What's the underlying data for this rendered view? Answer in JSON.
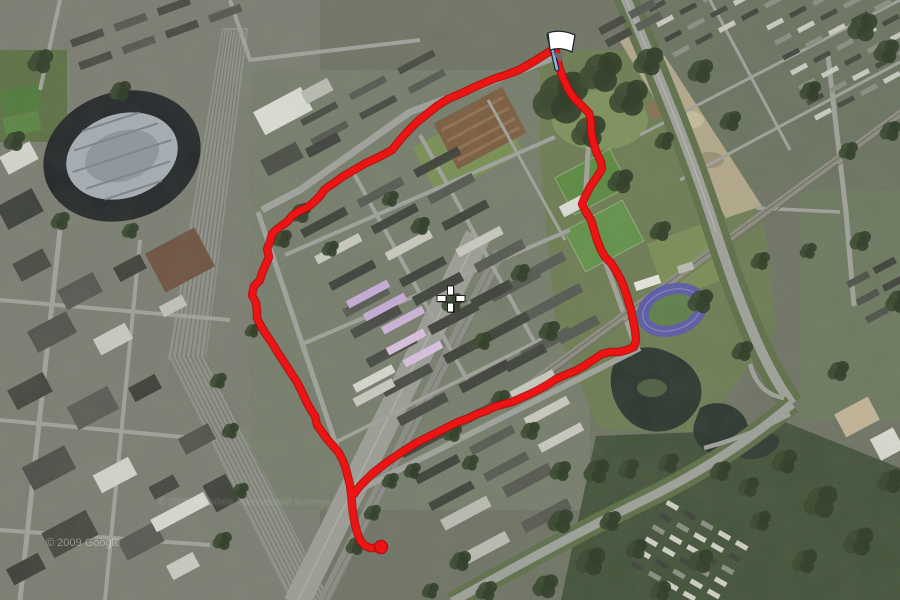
{
  "map_view": {
    "description": "Satellite aerial map with red GPS running route overlay",
    "watermark_primary": "© 2009 Google",
    "watermark_secondary": "© 2009 Aerodata International Surveys",
    "crosshair": {
      "x": 450.5,
      "y": 298.5
    },
    "flag_marker": {
      "x": 549,
      "y": 35,
      "pole_color": "#8fb6e8",
      "flag_color": "#ffffff",
      "outline_color": "#1d2733"
    },
    "route": {
      "color": "#ee1414",
      "outline_color": "#b50d0d",
      "width": 6,
      "end_dot": {
        "x": 381,
        "y": 547,
        "r": 6.5
      },
      "polylines": {
        "west_leg_and_tail": [
          [
            552,
            50
          ],
          [
            533,
            62
          ],
          [
            519,
            70
          ],
          [
            506,
            75
          ],
          [
            496,
            78
          ],
          [
            477,
            86
          ],
          [
            462,
            93
          ],
          [
            448,
            99
          ],
          [
            437,
            106
          ],
          [
            427,
            114
          ],
          [
            417,
            122
          ],
          [
            407,
            132
          ],
          [
            400,
            140
          ],
          [
            392,
            150
          ],
          [
            379,
            157
          ],
          [
            366,
            163
          ],
          [
            354,
            170
          ],
          [
            342,
            177
          ],
          [
            334,
            183
          ],
          [
            325,
            189
          ],
          [
            320,
            196
          ],
          [
            314,
            202
          ],
          [
            308,
            207
          ],
          [
            299,
            211
          ],
          [
            292,
            216
          ],
          [
            287,
            222
          ],
          [
            277,
            229
          ],
          [
            272,
            234
          ],
          [
            270,
            242
          ],
          [
            267,
            249
          ],
          [
            269,
            257
          ],
          [
            265,
            266
          ],
          [
            262,
            273
          ],
          [
            260,
            280
          ],
          [
            254,
            286
          ],
          [
            252,
            295
          ],
          [
            256,
            303
          ],
          [
            257,
            311
          ],
          [
            257,
            318
          ],
          [
            261,
            326
          ],
          [
            265,
            333
          ],
          [
            272,
            343
          ],
          [
            278,
            353
          ],
          [
            284,
            362
          ],
          [
            291,
            373
          ],
          [
            297,
            382
          ],
          [
            302,
            392
          ],
          [
            307,
            403
          ],
          [
            311,
            410
          ],
          [
            315,
            416
          ],
          [
            317,
            425
          ],
          [
            322,
            432
          ],
          [
            327,
            439
          ],
          [
            334,
            447
          ],
          [
            339,
            453
          ],
          [
            343,
            461
          ],
          [
            346,
            469
          ],
          [
            348,
            477
          ],
          [
            350,
            485
          ],
          [
            351,
            493
          ],
          [
            352,
            504
          ],
          [
            353,
            514
          ],
          [
            355,
            524
          ],
          [
            357,
            532
          ],
          [
            360,
            540
          ],
          [
            364,
            545
          ],
          [
            370,
            548
          ],
          [
            377,
            548
          ],
          [
            382,
            546
          ]
        ],
        "east_leg_and_south_return": [
          [
            556,
            52
          ],
          [
            559,
            67
          ],
          [
            563,
            78
          ],
          [
            568,
            89
          ],
          [
            574,
            98
          ],
          [
            583,
            107
          ],
          [
            589,
            113
          ],
          [
            591,
            122
          ],
          [
            591,
            131
          ],
          [
            593,
            141
          ],
          [
            596,
            151
          ],
          [
            601,
            162
          ],
          [
            602,
            169
          ],
          [
            597,
            177
          ],
          [
            590,
            187
          ],
          [
            585,
            197
          ],
          [
            582,
            204
          ],
          [
            586,
            212
          ],
          [
            591,
            220
          ],
          [
            594,
            230
          ],
          [
            597,
            240
          ],
          [
            601,
            250
          ],
          [
            605,
            257
          ],
          [
            611,
            263
          ],
          [
            616,
            271
          ],
          [
            621,
            280
          ],
          [
            625,
            290
          ],
          [
            628,
            300
          ],
          [
            631,
            310
          ],
          [
            633,
            320
          ],
          [
            635,
            330
          ],
          [
            636,
            340
          ],
          [
            634,
            347
          ],
          [
            627,
            350
          ],
          [
            619,
            352
          ],
          [
            610,
            352
          ],
          [
            602,
            354
          ],
          [
            593,
            360
          ],
          [
            584,
            366
          ],
          [
            575,
            371
          ],
          [
            565,
            375
          ],
          [
            556,
            379
          ],
          [
            547,
            385
          ],
          [
            538,
            390
          ],
          [
            530,
            394
          ],
          [
            521,
            398
          ],
          [
            512,
            402
          ],
          [
            504,
            404
          ],
          [
            494,
            407
          ],
          [
            486,
            411
          ],
          [
            477,
            414
          ],
          [
            469,
            418
          ],
          [
            458,
            422
          ],
          [
            448,
            427
          ],
          [
            438,
            432
          ],
          [
            428,
            437
          ],
          [
            418,
            442
          ],
          [
            408,
            448
          ],
          [
            399,
            454
          ],
          [
            390,
            460
          ],
          [
            382,
            466
          ],
          [
            373,
            473
          ],
          [
            366,
            480
          ],
          [
            360,
            486
          ],
          [
            356,
            491
          ],
          [
            354,
            494
          ]
        ]
      }
    }
  }
}
